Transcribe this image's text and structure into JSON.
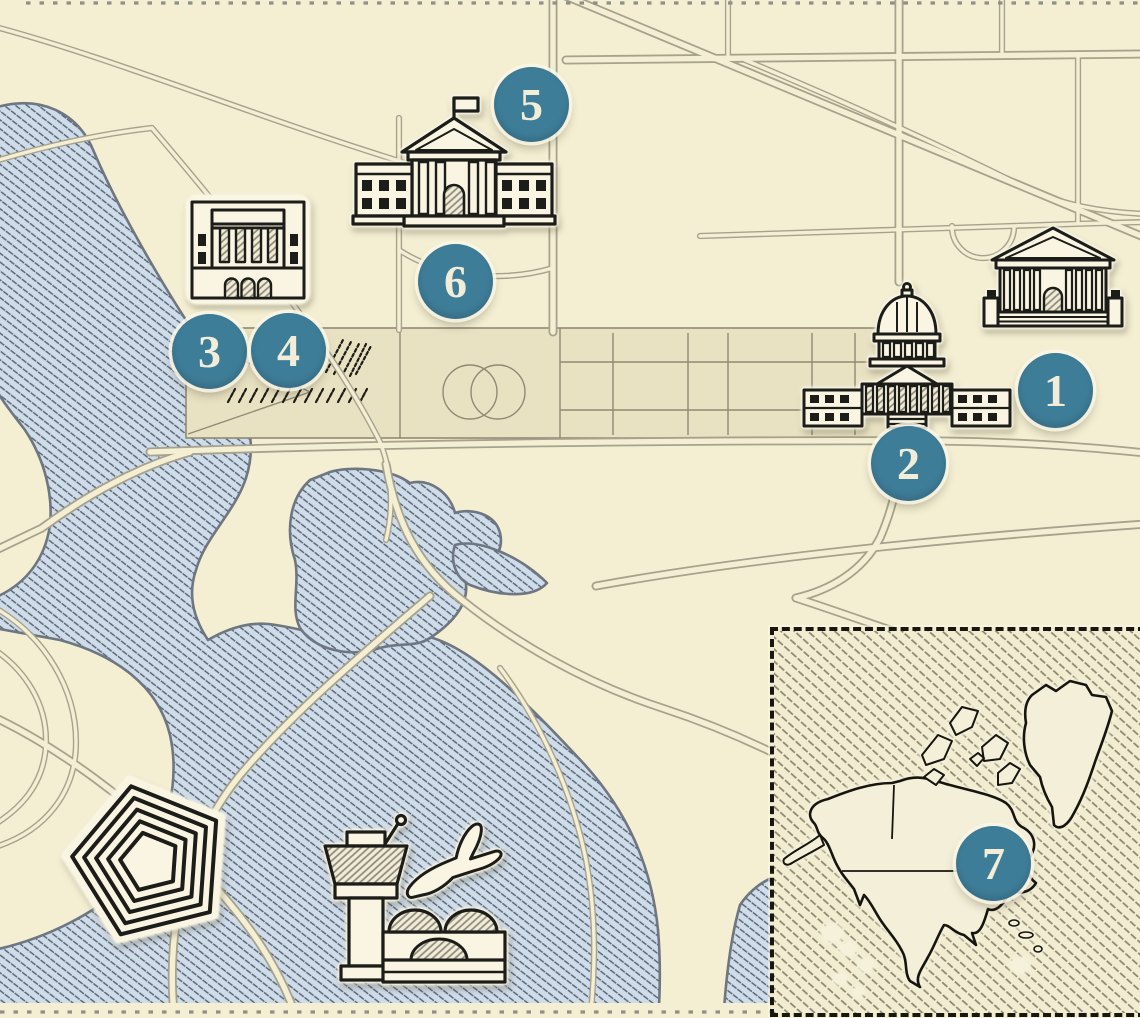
{
  "map": {
    "markers": [
      {
        "label": "1",
        "target": "supreme-court-building"
      },
      {
        "label": "2",
        "target": "capitol-building"
      },
      {
        "label": "3",
        "target": "memorial-building"
      },
      {
        "label": "4",
        "target": "memorial-building"
      },
      {
        "label": "5",
        "target": "white-house-building"
      },
      {
        "label": "6",
        "target": "white-house-building"
      },
      {
        "label": "7",
        "target": "north-america-inset-map"
      }
    ],
    "unnumbered_icons": [
      "pentagon-building",
      "airport-control-tower",
      "airplane"
    ],
    "colors": {
      "background": "#f4efd2",
      "mall_panel": "#e9e2c2",
      "water_fill": "#cfdce9",
      "water_hatch": "#55606d",
      "shoreline": "#6d7681",
      "road_casing": "#a7a28e",
      "ink": "#1c1c18",
      "halo": "#fbf8e8",
      "marker_fill": "#3e7d98",
      "marker_text": "#f1edd8",
      "inset_hatch": "#8a8470"
    }
  },
  "inset": {
    "marker_label": "7"
  }
}
